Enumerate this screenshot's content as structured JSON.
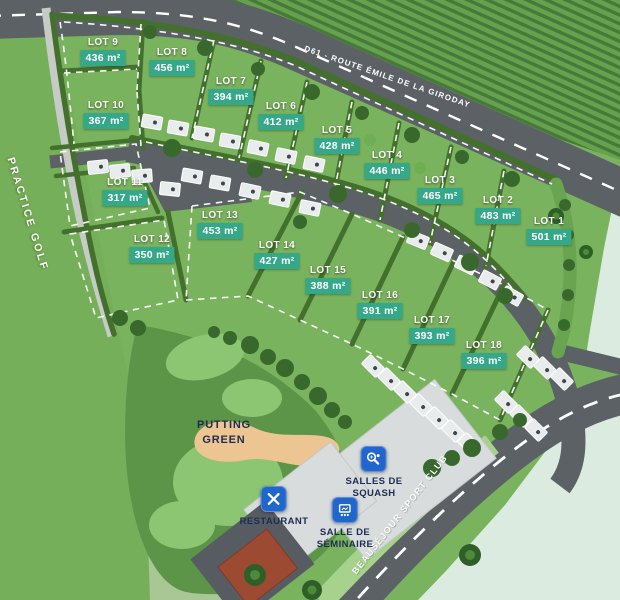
{
  "map": {
    "road_label": "D61 - ROUTE ÉMILE DE LA GIRODAY",
    "practice_golf_label": "PRACTICE GOLF",
    "putting_green_label": "PUTTING\nGREEN",
    "sport_club_label": "BEAUSÉJOUR SPORT CLUB",
    "amenities": {
      "squash": {
        "label": "SALLES DE\nSQUASH"
      },
      "restaurant": {
        "label": "RESTAURANT"
      },
      "seminaire": {
        "label": "SALLE DE\nSÉMINAIRE"
      }
    },
    "lots": [
      {
        "name": "LOT 1",
        "area": "501 m²"
      },
      {
        "name": "LOT 2",
        "area": "483 m²"
      },
      {
        "name": "LOT 3",
        "area": "465 m²"
      },
      {
        "name": "LOT 4",
        "area": "446 m²"
      },
      {
        "name": "LOT 5",
        "area": "428 m²"
      },
      {
        "name": "LOT 6",
        "area": "412 m²"
      },
      {
        "name": "LOT 7",
        "area": "394 m²"
      },
      {
        "name": "LOT 8",
        "area": "456 m²"
      },
      {
        "name": "LOT 9",
        "area": "436 m²"
      },
      {
        "name": "LOT 10",
        "area": "367 m²"
      },
      {
        "name": "LOT 11",
        "area": "317 m²"
      },
      {
        "name": "LOT 12",
        "area": "350 m²"
      },
      {
        "name": "LOT 13",
        "area": "453 m²"
      },
      {
        "name": "LOT 14",
        "area": "427 m²"
      },
      {
        "name": "LOT 15",
        "area": "388 m²"
      },
      {
        "name": "LOT 16",
        "area": "391 m²"
      },
      {
        "name": "LOT 17",
        "area": "393 m²"
      },
      {
        "name": "LOT 18",
        "area": "396 m²"
      }
    ],
    "colors": {
      "lot_area_badge": "#35a88a",
      "amenity_tile_blue": "#2166cd",
      "navy_text": "#1e2c52",
      "grass": "#7ab35e",
      "road_gray": "#5c6165",
      "outside_mint": "#dcebe0"
    }
  }
}
